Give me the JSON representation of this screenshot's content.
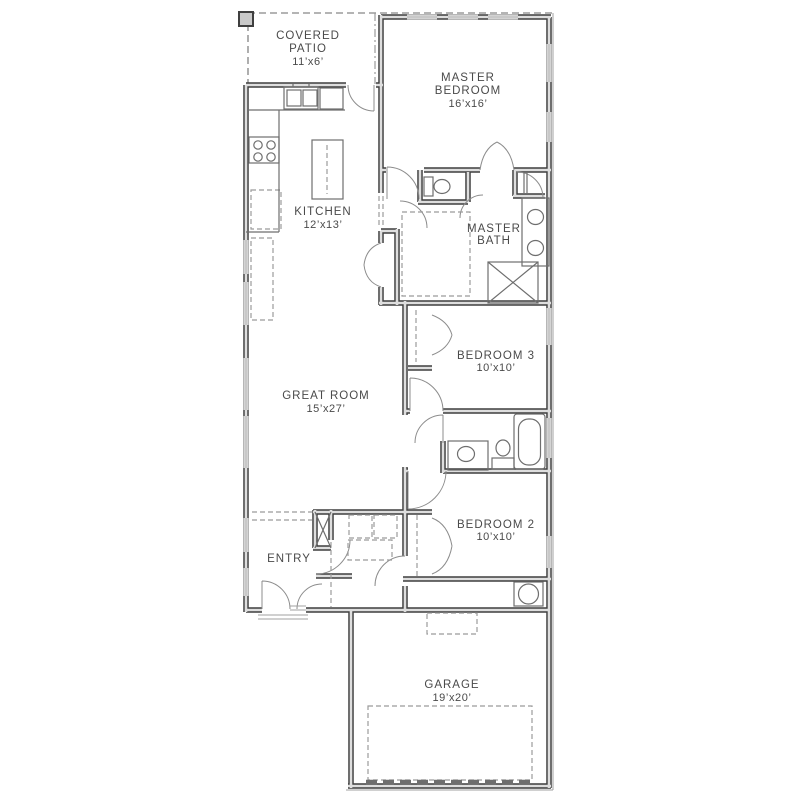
{
  "plan": {
    "title": "single-story house floor plan",
    "rooms": {
      "covered_patio": {
        "line1": "COVERED",
        "line2": "PATIO",
        "dims": "11’x6’"
      },
      "master_bedroom": {
        "line1": "MASTER",
        "line2": "BEDROOM",
        "dims": "16’x16’"
      },
      "kitchen": {
        "line1": "KITCHEN",
        "dims": "12’x13’"
      },
      "master_bath": {
        "line1": "MASTER",
        "line2": "BATH"
      },
      "great_room": {
        "line1": "GREAT ROOM",
        "dims": "15’x27’"
      },
      "bedroom_3": {
        "line1": "BEDROOM 3",
        "dims": "10’x10’"
      },
      "bedroom_2": {
        "line1": "BEDROOM 2",
        "dims": "10’x10’"
      },
      "entry": {
        "line1": "ENTRY"
      },
      "garage": {
        "line1": "GARAGE",
        "dims": "19’x20’"
      }
    },
    "fixtures": [
      "patio-post",
      "kitchen-sink-double",
      "dishwasher",
      "range-cooktop",
      "refrigerator-optional",
      "kitchen-island",
      "water-closet-toilet",
      "master-vanity-double-sink",
      "linen-shelves",
      "walk-in-closet-shelving",
      "shower",
      "bathtub",
      "hall-bath-vanity-sink",
      "hall-bath-toilet",
      "coat-closet",
      "washer",
      "dryer",
      "water-heater",
      "attic-access",
      "garage-parking-pad",
      "garage-door",
      "front-door",
      "porch-step"
    ],
    "colors": {
      "wall": "#3f3f3f",
      "wall-fill": "#dedede",
      "window": "#bdbdbd",
      "fixture": "#6e6e6e",
      "dashed": "#9b9b9b",
      "text": "#4a4a4a",
      "background": "#ffffff",
      "post-fill": "#c9c9c9"
    }
  }
}
